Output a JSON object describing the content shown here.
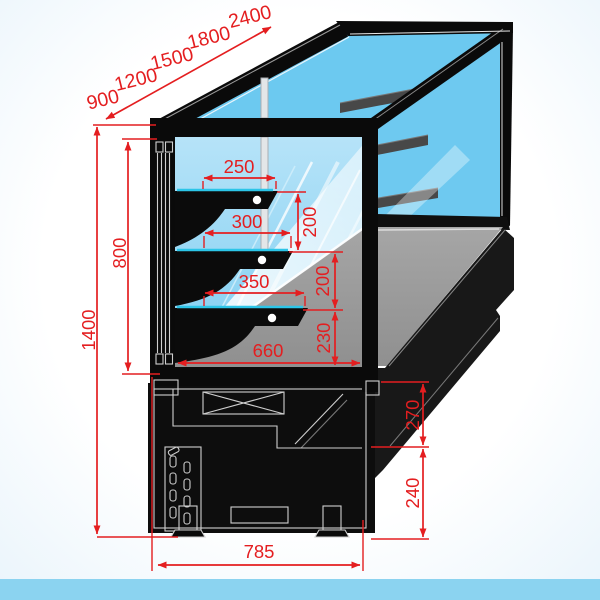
{
  "canvas": {
    "width": 600,
    "height": 600
  },
  "colors": {
    "dimension_red": "#E41E20",
    "glass_blue": "#6EC9F0",
    "interior_blue": "#9FD9F4",
    "deck_gray": "#9B9B9B",
    "cabinet_black": "#0D0D0D",
    "shelf_edge_cyan": "#2CC5E8",
    "footer_bar_blue": "#8BD3F0"
  },
  "dimensions": {
    "length_options": [
      "900",
      "1200",
      "1500",
      "1800",
      "2400"
    ],
    "total_height": "1400",
    "glass_height": "800",
    "shelf_depths": [
      "250",
      "300",
      "350"
    ],
    "shelf_gaps": [
      "200",
      "200"
    ],
    "shelf_to_deck": "230",
    "deck_depth": "660",
    "base_back_upper": "270",
    "base_back_lower": "240",
    "base_depth": "785"
  }
}
